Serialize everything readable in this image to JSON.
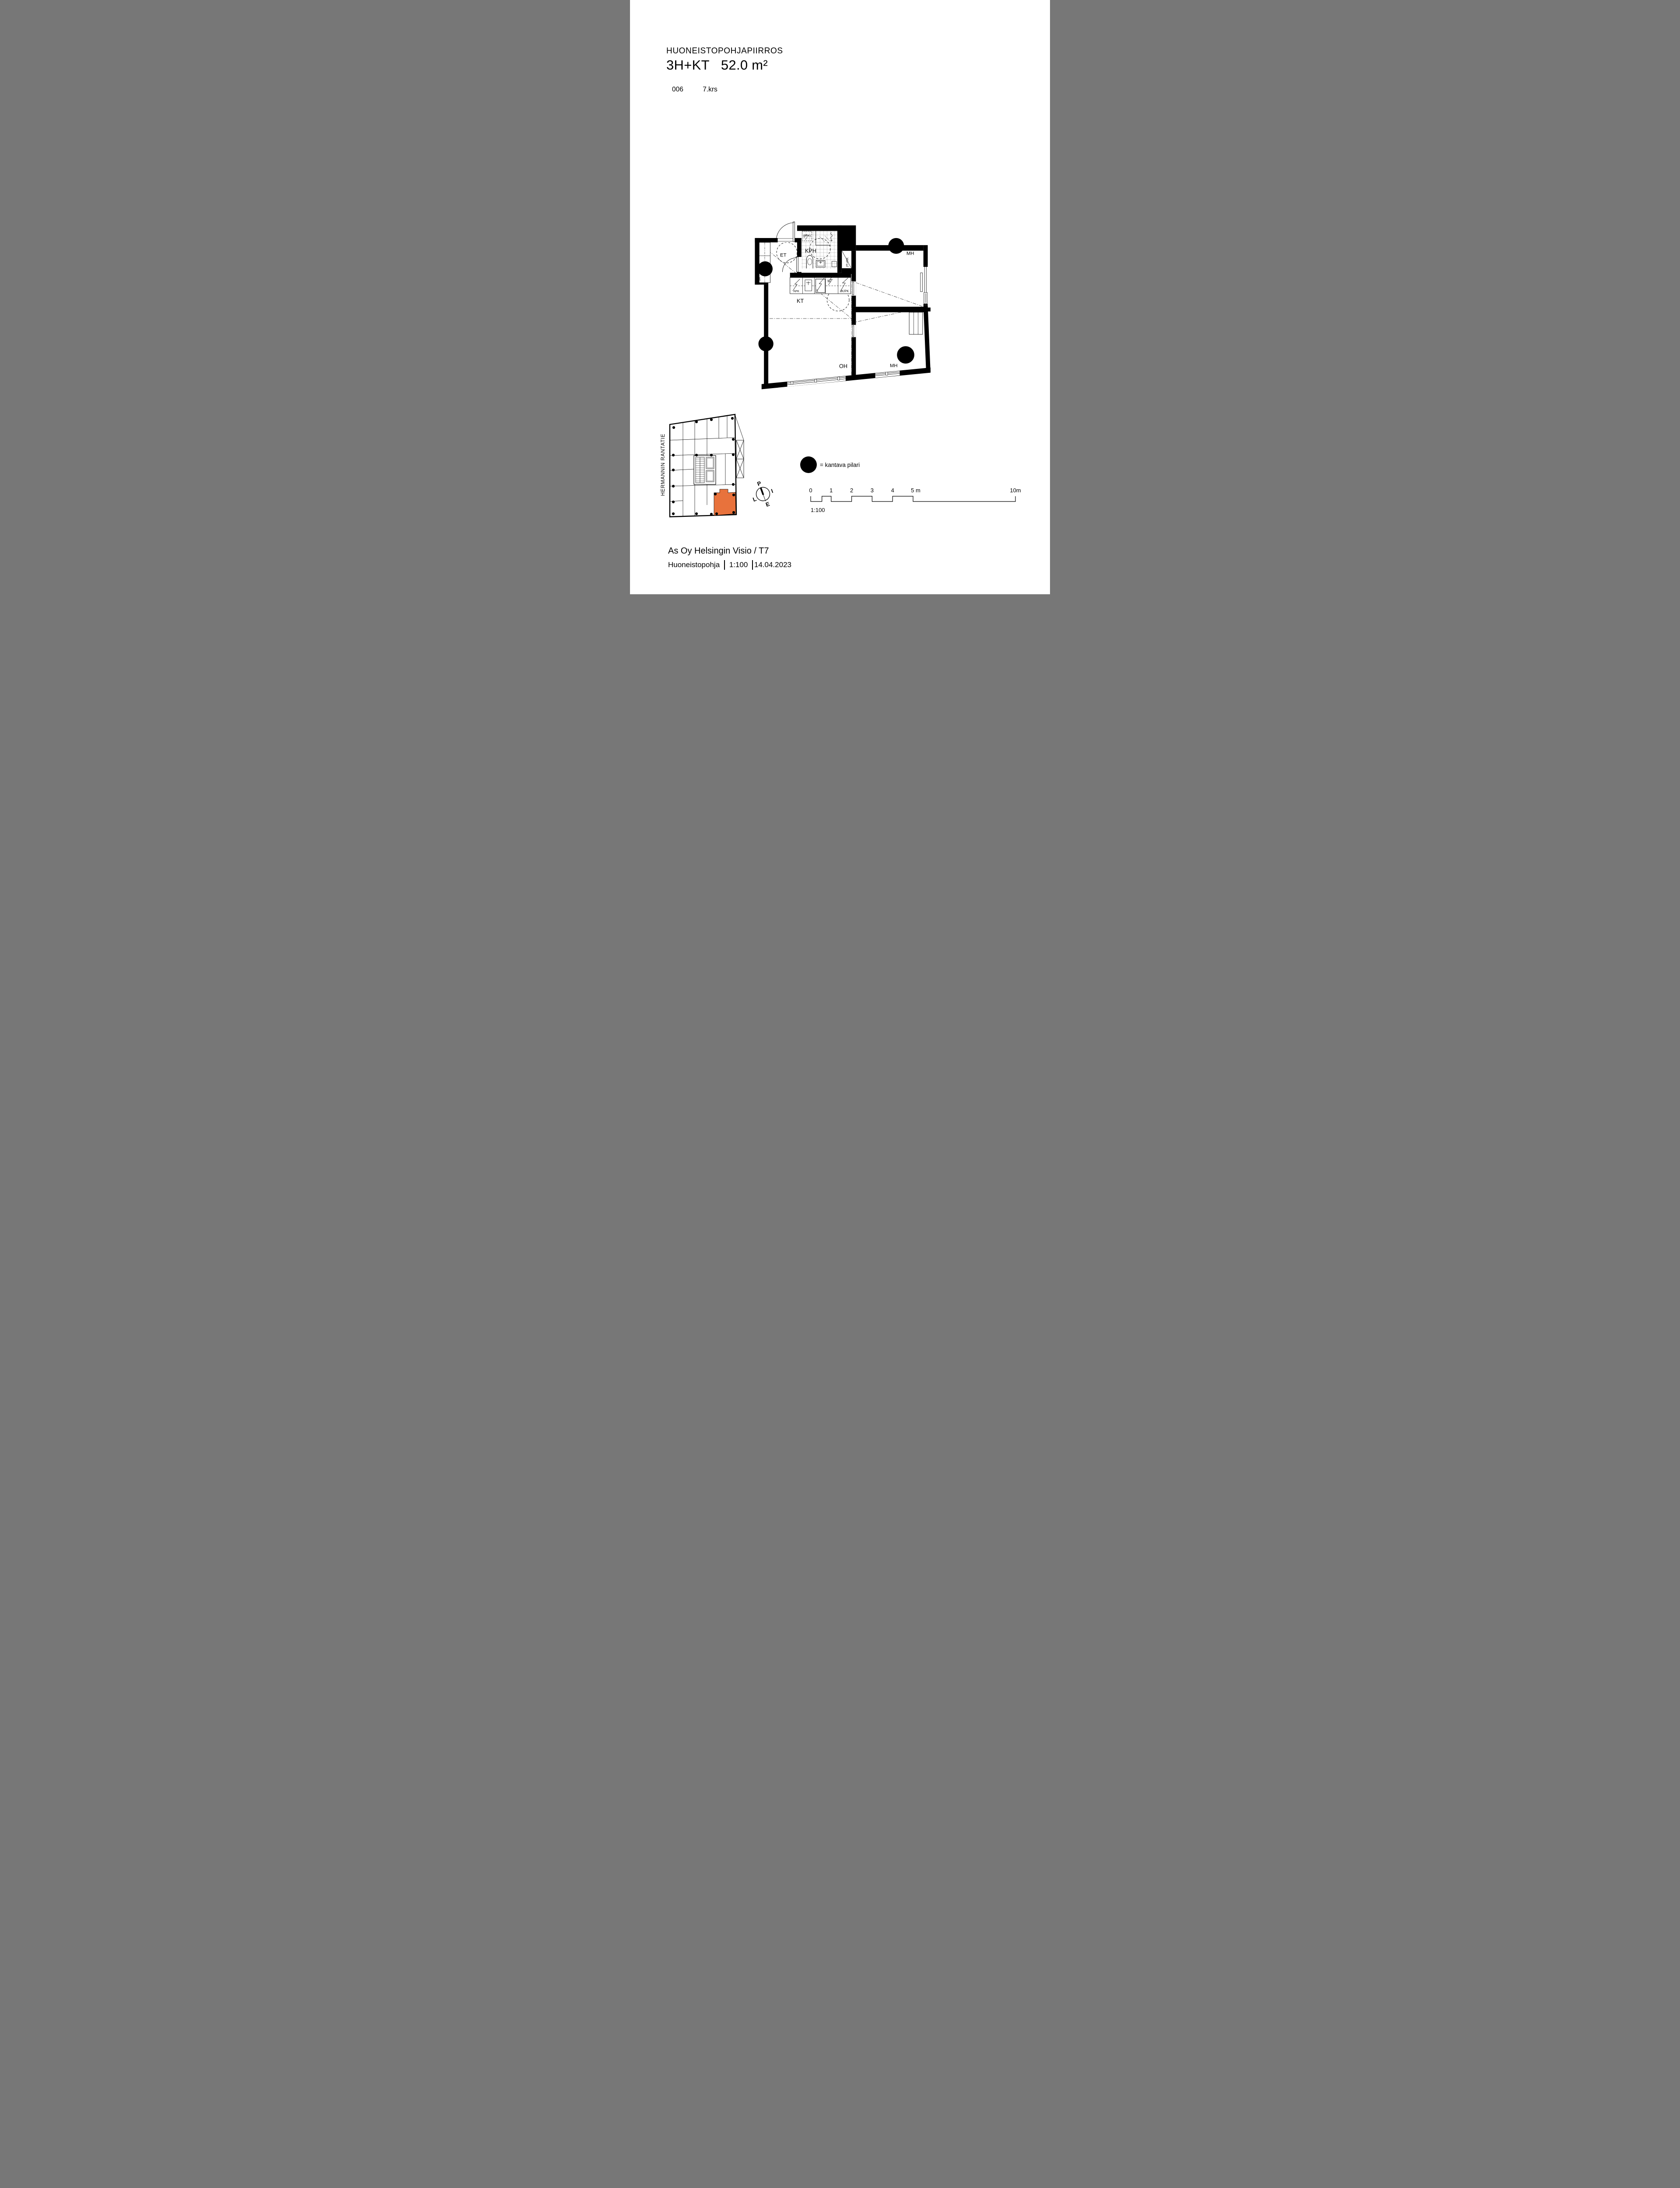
{
  "header": {
    "doc_type": "HUONEISTOPOHJAPIIRROS",
    "apartment_type": "3H+KT",
    "area": "52.0 m²",
    "apartment_number": "006",
    "floor": "7.krs"
  },
  "plan": {
    "rooms": {
      "entry": "ET",
      "bathroom": "KPH",
      "kitchen": "KT",
      "living": "OH",
      "bedroom_top": "MH",
      "bedroom_bottom": "MH"
    },
    "fixtures": {
      "washing_machine_reserved": "(PPK)",
      "closet": "SK",
      "duct": "JT+RK",
      "dishwasher": "APK",
      "stove": "L",
      "microwave": "M",
      "fridge_freezer": "JK/PK"
    }
  },
  "legend": {
    "pillar_label": "= kantava pilari"
  },
  "compass": {
    "north": "P",
    "east": "I",
    "south": "E",
    "west": "L"
  },
  "scale_bar": {
    "labels": [
      "0",
      "1",
      "2",
      "3",
      "4",
      "5 m",
      "10m"
    ],
    "scale": "1:100"
  },
  "site_plan": {
    "street_name": "HERMANNIN RANTATIE",
    "highlight_color": "#E8723C"
  },
  "footer": {
    "project": "As Oy Helsingin Visio / T7",
    "doc_name": "Huoneistopohja",
    "scale": "1:100",
    "date": "14.04.2023"
  }
}
